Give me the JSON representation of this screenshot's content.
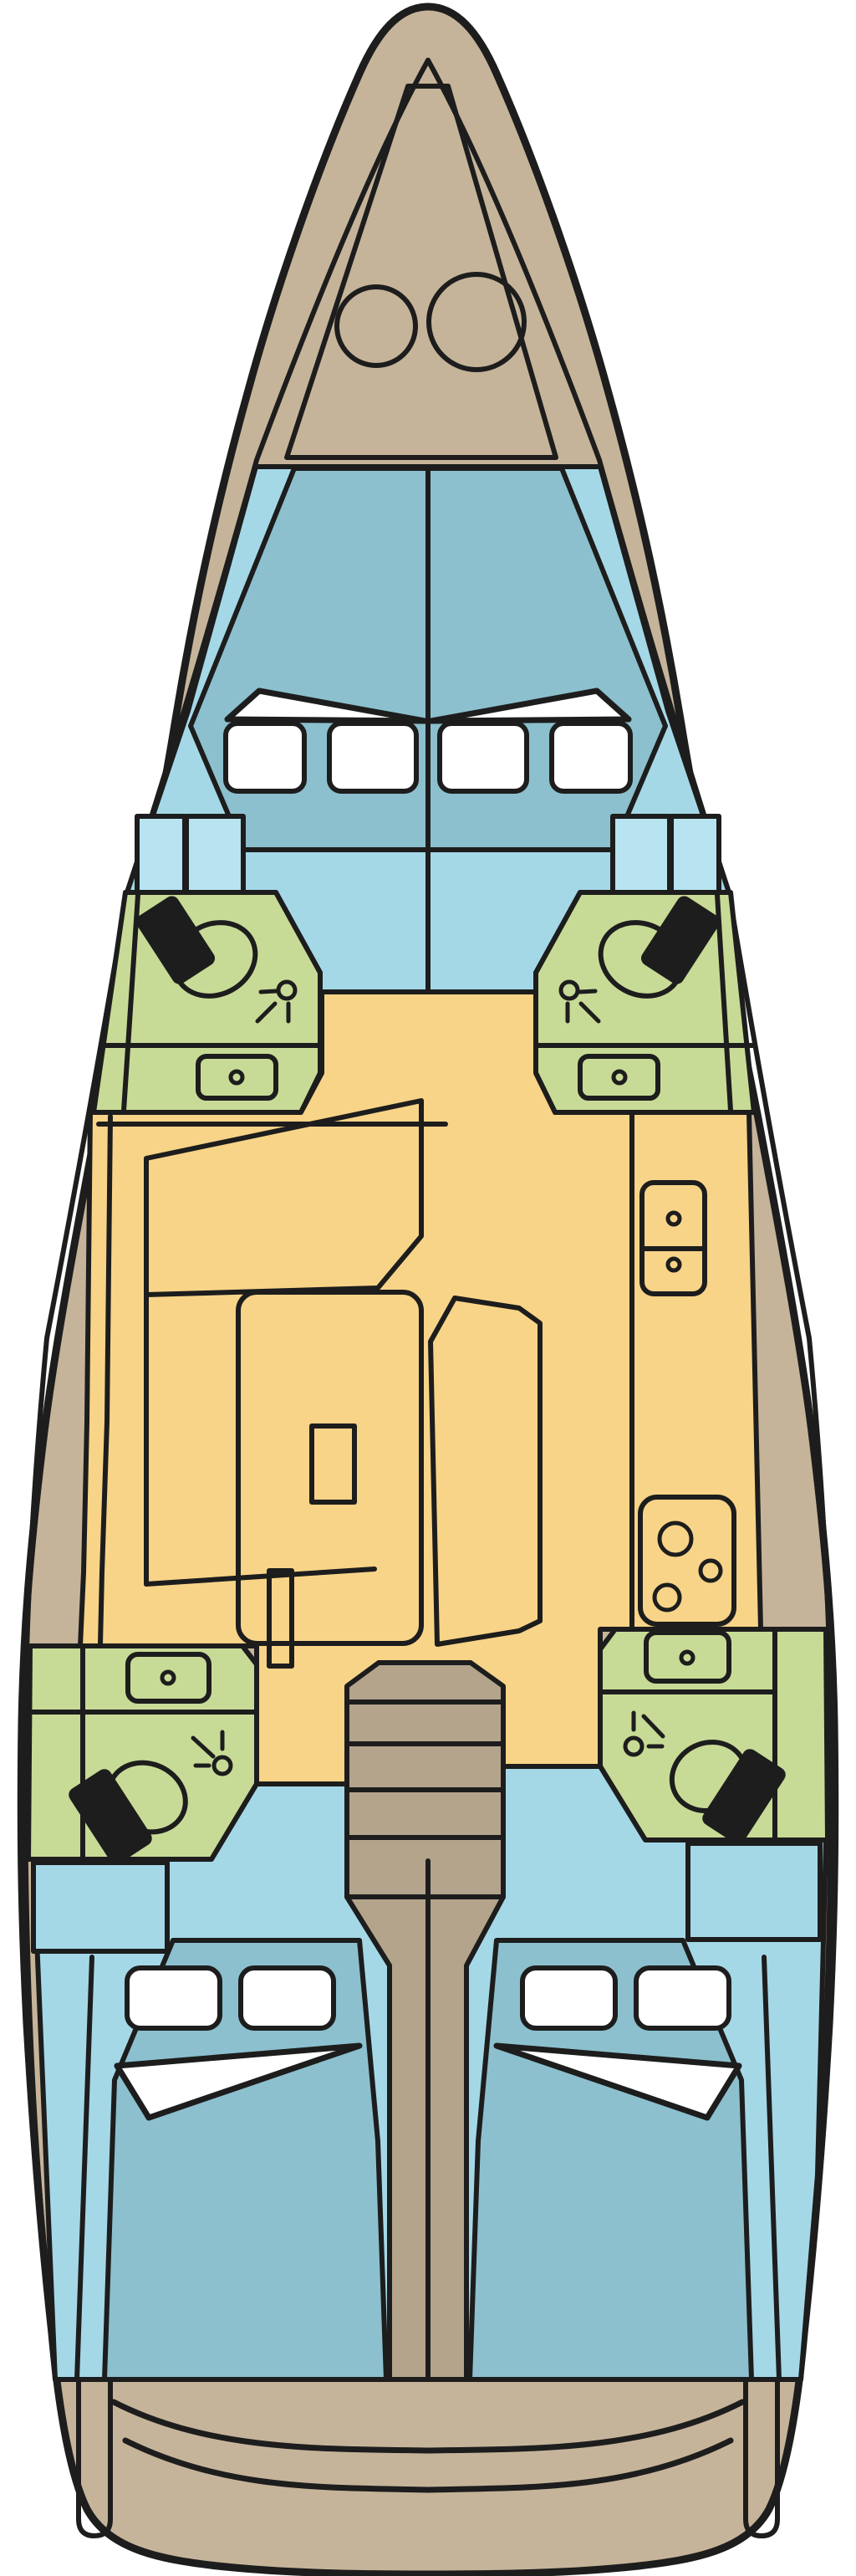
{
  "diagram": {
    "type": "yacht-interior-floor-plan",
    "orientation": "bow-at-top"
  },
  "colors": {
    "line": "#1d1d1d",
    "hull": "#c6b49a",
    "deck": "#b4a48c",
    "floor": "#a5d8e7",
    "light": "#b7e4f0",
    "bed": "#8cc0ce",
    "green": "#c8db96",
    "yellow": "#f8d488",
    "white": "#ffffff",
    "background": "#ffffff"
  },
  "regions": [
    {
      "name": "bow-deck",
      "color": "hull"
    },
    {
      "name": "anchor-locker",
      "color": "hull"
    },
    {
      "name": "forward-cabin",
      "color": "floor"
    },
    {
      "name": "forward-berth",
      "color": "bed"
    },
    {
      "name": "forward-head-port",
      "color": "green"
    },
    {
      "name": "forward-head-starboard",
      "color": "green"
    },
    {
      "name": "saloon",
      "color": "yellow"
    },
    {
      "name": "galley",
      "color": "yellow"
    },
    {
      "name": "companionway-steps",
      "color": "deck"
    },
    {
      "name": "aft-head-port",
      "color": "green"
    },
    {
      "name": "aft-head-starboard",
      "color": "green"
    },
    {
      "name": "aft-cabin-port",
      "color": "floor"
    },
    {
      "name": "aft-berth-port",
      "color": "bed"
    },
    {
      "name": "aft-cabin-starboard",
      "color": "floor"
    },
    {
      "name": "aft-berth-starboard",
      "color": "bed"
    },
    {
      "name": "stern-deck",
      "color": "hull"
    }
  ],
  "features": [
    "windlass-drums",
    "v-berth",
    "hull-windows",
    "wardrobes",
    "toilets",
    "showers",
    "sinks",
    "settee",
    "saloon-table",
    "chaise-bench",
    "galley-sink",
    "stove-burners",
    "companionway-stairs",
    "double-berths",
    "pillows",
    "folded-sheets",
    "transom-seats"
  ]
}
